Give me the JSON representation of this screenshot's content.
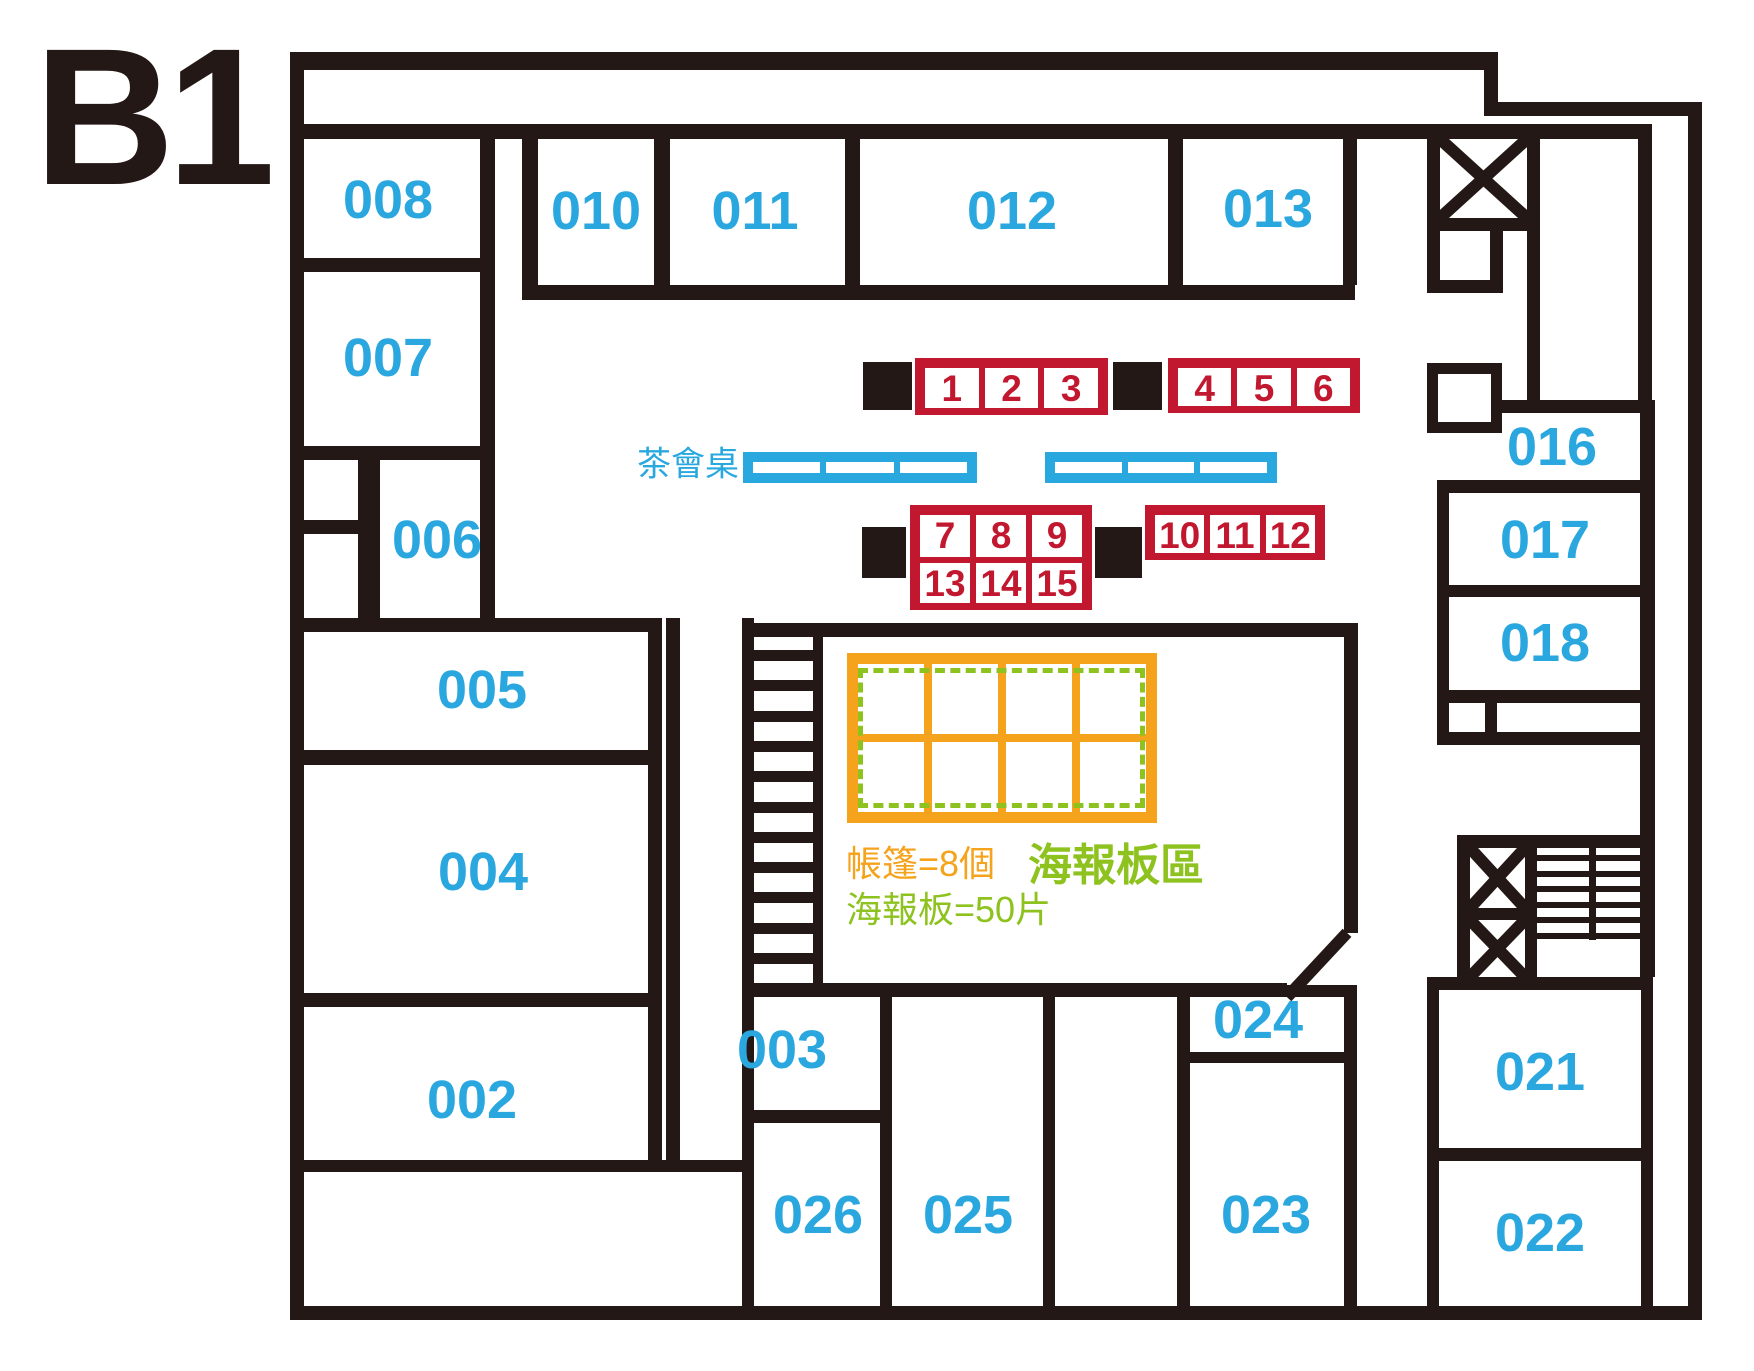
{
  "title": {
    "text": "B1"
  },
  "canvas": {
    "w": 1754,
    "h": 1371
  },
  "colors": {
    "wall": "#231815",
    "room_label_blue": "#2AA7DF",
    "booth_red": "#C2182F",
    "table_blue": "#29A8E0",
    "tent_orange": "#F5A21C",
    "poster_green": "#8DC21F"
  },
  "rooms": [
    {
      "label": "008",
      "cx": 388,
      "cy": 200
    },
    {
      "label": "007",
      "cx": 388,
      "cy": 358
    },
    {
      "label": "006",
      "cx": 437,
      "cy": 540
    },
    {
      "label": "005",
      "cx": 482,
      "cy": 690
    },
    {
      "label": "004",
      "cx": 483,
      "cy": 872
    },
    {
      "label": "002",
      "cx": 472,
      "cy": 1100
    },
    {
      "label": "010",
      "cx": 596,
      "cy": 211
    },
    {
      "label": "011",
      "cx": 755,
      "cy": 211
    },
    {
      "label": "012",
      "cx": 1012,
      "cy": 211
    },
    {
      "label": "013",
      "cx": 1268,
      "cy": 209
    },
    {
      "label": "016",
      "cx": 1552,
      "cy": 447
    },
    {
      "label": "017",
      "cx": 1545,
      "cy": 540
    },
    {
      "label": "018",
      "cx": 1545,
      "cy": 643
    },
    {
      "label": "021",
      "cx": 1540,
      "cy": 1072
    },
    {
      "label": "022",
      "cx": 1540,
      "cy": 1233
    },
    {
      "label": "023",
      "cx": 1266,
      "cy": 1215
    },
    {
      "label": "024",
      "cx": 1258,
      "cy": 1020
    },
    {
      "label": "025",
      "cx": 968,
      "cy": 1215
    },
    {
      "label": "026",
      "cx": 818,
      "cy": 1215
    },
    {
      "label": "003",
      "cx": 782,
      "cy": 1050
    }
  ],
  "booth_groups": [
    {
      "name": "booths-1-3",
      "x": 915,
      "y": 358,
      "w": 193,
      "h": 57,
      "cols": 3,
      "rows": 1,
      "labels": [
        "1",
        "2",
        "3"
      ]
    },
    {
      "name": "booths-4-6",
      "x": 1168,
      "y": 358,
      "w": 192,
      "h": 55,
      "cols": 3,
      "rows": 1,
      "labels": [
        "4",
        "5",
        "6"
      ]
    },
    {
      "name": "booths-7-15",
      "x": 910,
      "y": 505,
      "w": 182,
      "h": 105,
      "cols": 3,
      "rows": 2,
      "labels": [
        "7",
        "8",
        "9",
        "13",
        "14",
        "15"
      ]
    },
    {
      "name": "booths-10-12",
      "x": 1145,
      "y": 505,
      "w": 180,
      "h": 55,
      "cols": 3,
      "rows": 1,
      "labels": [
        "10",
        "11",
        "12"
      ]
    }
  ],
  "black_squares": [
    {
      "name": "block-square-1",
      "x": 863,
      "y": 362,
      "w": 49,
      "h": 48
    },
    {
      "name": "block-square-2",
      "x": 1113,
      "y": 362,
      "w": 49,
      "h": 48
    },
    {
      "name": "block-square-3",
      "x": 862,
      "y": 527,
      "w": 44,
      "h": 51
    },
    {
      "name": "block-square-4",
      "x": 1095,
      "y": 527,
      "w": 47,
      "h": 51
    }
  ],
  "tables": [
    {
      "name": "tea-table-left",
      "x": 743,
      "y": 452,
      "w": 234,
      "h": 31,
      "cols": 3
    },
    {
      "name": "tea-table-right",
      "x": 1045,
      "y": 452,
      "w": 232,
      "h": 31,
      "cols": 3
    }
  ],
  "tea_label": {
    "text": "茶會桌",
    "x": 739,
    "y": 461
  },
  "tent_area": {
    "grid": {
      "x": 847,
      "y": 653,
      "w": 310,
      "h": 170,
      "cols": 4,
      "rows": 2
    },
    "dashed": {
      "x": 858,
      "y": 668,
      "w": 287,
      "h": 140
    },
    "tent_count_label": {
      "text": "帳篷=8個",
      "x": 846,
      "y": 835
    },
    "poster_count_label": {
      "text": "海報板=50片",
      "x": 846,
      "y": 881
    },
    "poster_area_label": {
      "text": "海報板區",
      "x": 1028,
      "y": 829
    }
  },
  "walls": [
    {
      "name": "outer-wall-left",
      "x": 290,
      "y": 52,
      "w": 14,
      "h": 1268
    },
    {
      "name": "outer-wall-top",
      "x": 290,
      "y": 52,
      "w": 1208,
      "h": 18
    },
    {
      "name": "outer-wall-step-vertical",
      "x": 1484,
      "y": 52,
      "w": 14,
      "h": 62
    },
    {
      "name": "outer-wall-step-horizontal",
      "x": 1484,
      "y": 102,
      "w": 218,
      "h": 14
    },
    {
      "name": "outer-wall-right",
      "x": 1688,
      "y": 102,
      "w": 14,
      "h": 1218
    },
    {
      "name": "outer-wall-bottom",
      "x": 290,
      "y": 1306,
      "w": 1412,
      "h": 14
    },
    {
      "name": "corridor-top-wall",
      "x": 302,
      "y": 124,
      "w": 1348,
      "h": 15
    },
    {
      "name": "room008-right-wall",
      "x": 480,
      "y": 124,
      "w": 15,
      "h": 508
    },
    {
      "name": "room008-bottom-wall",
      "x": 302,
      "y": 258,
      "w": 178,
      "h": 14
    },
    {
      "name": "room007-bottom-wall",
      "x": 302,
      "y": 446,
      "w": 193,
      "h": 14
    },
    {
      "name": "closet-column-wall",
      "x": 358,
      "y": 460,
      "w": 22,
      "h": 162
    },
    {
      "name": "closet-divider-wall",
      "x": 302,
      "y": 520,
      "w": 68,
      "h": 14
    },
    {
      "name": "room005-top-wall",
      "x": 302,
      "y": 618,
      "w": 360,
      "h": 14
    },
    {
      "name": "room005-bottom-wall",
      "x": 302,
      "y": 750,
      "w": 360,
      "h": 15
    },
    {
      "name": "room004-bottom-wall",
      "x": 302,
      "y": 993,
      "w": 359,
      "h": 14
    },
    {
      "name": "room002-bottom-wall",
      "x": 302,
      "y": 1160,
      "w": 451,
      "h": 12
    },
    {
      "name": "left-block-right-wall",
      "x": 648,
      "y": 618,
      "w": 14,
      "h": 554
    },
    {
      "name": "hall-west-wall",
      "x": 666,
      "y": 618,
      "w": 14,
      "h": 549
    },
    {
      "name": "room010-left-wall",
      "x": 522,
      "y": 124,
      "w": 16,
      "h": 176
    },
    {
      "name": "toprooms-bottom-wall",
      "x": 522,
      "y": 285,
      "w": 833,
      "h": 15
    },
    {
      "name": "divider-010-011",
      "x": 654,
      "y": 139,
      "w": 16,
      "h": 146
    },
    {
      "name": "divider-011-012",
      "x": 845,
      "y": 139,
      "w": 15,
      "h": 146
    },
    {
      "name": "divider-012-013",
      "x": 1168,
      "y": 139,
      "w": 15,
      "h": 146
    },
    {
      "name": "room013-right-wall",
      "x": 1343,
      "y": 139,
      "w": 14,
      "h": 146
    },
    {
      "name": "shaft-left-wall",
      "x": 1427,
      "y": 124,
      "w": 13,
      "h": 169
    },
    {
      "name": "shaft-mid-wall",
      "x": 1527,
      "y": 139,
      "w": 13,
      "h": 274
    },
    {
      "name": "elevator-bottom-wall",
      "x": 1427,
      "y": 218,
      "w": 113,
      "h": 13
    },
    {
      "name": "shaft-smallbox-right-wall",
      "x": 1490,
      "y": 231,
      "w": 13,
      "h": 62
    },
    {
      "name": "shaft-smallbox-bottom-wall",
      "x": 1427,
      "y": 280,
      "w": 76,
      "h": 13
    },
    {
      "name": "shaft-right-wall",
      "x": 1638,
      "y": 124,
      "w": 14,
      "h": 289
    },
    {
      "name": "room016-top-wall",
      "x": 1495,
      "y": 400,
      "w": 160,
      "h": 13
    },
    {
      "name": "room016-bottom-wall",
      "x": 1437,
      "y": 480,
      "w": 218,
      "h": 13
    },
    {
      "name": "right-block-left-wall",
      "x": 1437,
      "y": 480,
      "w": 12,
      "h": 265
    },
    {
      "name": "room017-bottom-wall",
      "x": 1437,
      "y": 585,
      "w": 218,
      "h": 12
    },
    {
      "name": "room018-bottom-wall",
      "x": 1437,
      "y": 690,
      "w": 218,
      "h": 13
    },
    {
      "name": "smallrow-divider-wall",
      "x": 1485,
      "y": 703,
      "w": 12,
      "h": 29
    },
    {
      "name": "right-block-bottom-wall",
      "x": 1437,
      "y": 732,
      "w": 218,
      "h": 13
    },
    {
      "name": "right-corridor-inner-wall",
      "x": 1640,
      "y": 400,
      "w": 15,
      "h": 577
    },
    {
      "name": "stairshaft-top-wall",
      "x": 1457,
      "y": 835,
      "w": 196,
      "h": 13
    },
    {
      "name": "stairshaft-left-wall",
      "x": 1457,
      "y": 835,
      "w": 13,
      "h": 145
    },
    {
      "name": "stairshaft-x-divider",
      "x": 1457,
      "y": 908,
      "w": 80,
      "h": 12
    },
    {
      "name": "stairshaft-x-right-wall",
      "x": 1525,
      "y": 835,
      "w": 12,
      "h": 145
    },
    {
      "name": "stairshaft-hatch-center",
      "x": 1589,
      "y": 848,
      "w": 7,
      "h": 92
    },
    {
      "name": "room021-top-wall",
      "x": 1427,
      "y": 977,
      "w": 226,
      "h": 13
    },
    {
      "name": "rooms2122-left-wall",
      "x": 1427,
      "y": 977,
      "w": 12,
      "h": 330
    },
    {
      "name": "divider-021-022",
      "x": 1437,
      "y": 1148,
      "w": 216,
      "h": 13
    },
    {
      "name": "rooms2122-right-wall",
      "x": 1641,
      "y": 977,
      "w": 12,
      "h": 330
    },
    {
      "name": "stairs1-right-wall",
      "x": 813,
      "y": 637,
      "w": 10,
      "h": 360
    },
    {
      "name": "poster-room-left-wall",
      "x": 742,
      "y": 618,
      "w": 12,
      "h": 702
    },
    {
      "name": "poster-room-top-wall",
      "x": 742,
      "y": 623,
      "w": 616,
      "h": 14
    },
    {
      "name": "poster-room-right-wall",
      "x": 1344,
      "y": 623,
      "w": 14,
      "h": 310
    },
    {
      "name": "poster-room-bottom-wall",
      "x": 742,
      "y": 983,
      "w": 545,
      "h": 14
    },
    {
      "name": "divider-003-026",
      "x": 742,
      "y": 1110,
      "w": 150,
      "h": 13
    },
    {
      "name": "room026-right-wall",
      "x": 880,
      "y": 997,
      "w": 12,
      "h": 310
    },
    {
      "name": "room025-top-wall",
      "x": 880,
      "y": 985,
      "w": 175,
      "h": 12
    },
    {
      "name": "room025-right-wall",
      "x": 1043,
      "y": 985,
      "w": 12,
      "h": 322
    },
    {
      "name": "rooms2324-left-wall",
      "x": 1177,
      "y": 985,
      "w": 13,
      "h": 322
    },
    {
      "name": "rooms2324-top-wall",
      "x": 1177,
      "y": 985,
      "w": 180,
      "h": 12
    },
    {
      "name": "divider-024-023",
      "x": 1177,
      "y": 1052,
      "w": 180,
      "h": 11
    },
    {
      "name": "rooms2324-right-wall",
      "x": 1344,
      "y": 985,
      "w": 13,
      "h": 322
    }
  ],
  "diagonal_wall": {
    "name": "poster-room-diagonal-wall",
    "x": 1273,
    "y": 959,
    "w": 88,
    "h": 12,
    "angle": -47
  },
  "stairs_ladder": {
    "name": "stairs-top-left",
    "x": 754,
    "w": 59,
    "y0": 650,
    "step": 30.3,
    "count": 11,
    "thick": 11
  },
  "hatch_stairs": {
    "name": "stairs-bottom-right",
    "x": 1537,
    "w": 103,
    "y0": 855,
    "step": 15.5,
    "count": 6,
    "thick": 6
  },
  "xboxes": [
    {
      "name": "elevator-x-icon-top",
      "x": 1440,
      "y": 139,
      "w": 87,
      "h": 79
    },
    {
      "name": "elevator-x-icon-bottom-1",
      "x": 1470,
      "y": 848,
      "w": 55,
      "h": 60
    },
    {
      "name": "elevator-x-icon-bottom-2",
      "x": 1470,
      "y": 920,
      "w": 55,
      "h": 57
    }
  ],
  "closet_box": {
    "name": "shaft-closet-box",
    "x": 1427,
    "y": 363,
    "w": 75,
    "h": 70
  }
}
